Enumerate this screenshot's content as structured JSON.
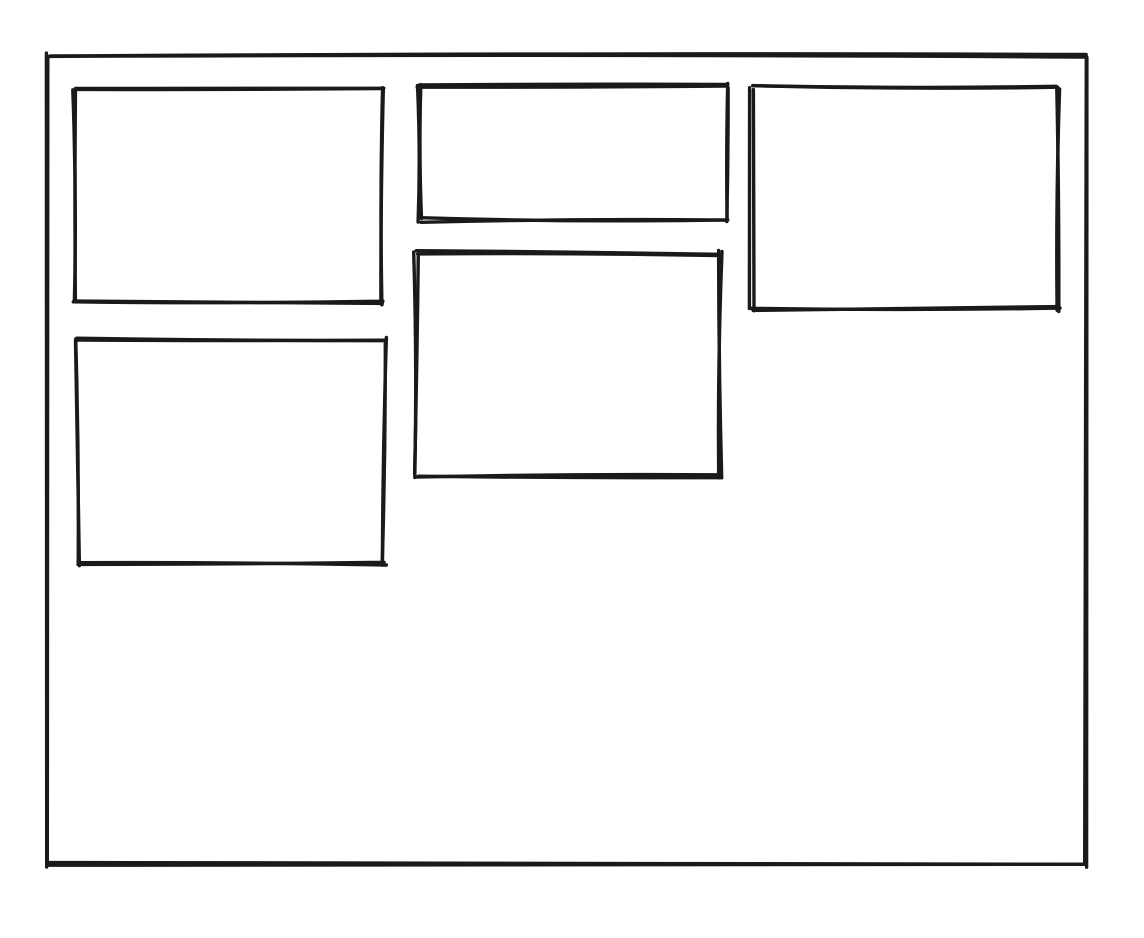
{
  "canvas": {
    "width": 1144,
    "height": 938,
    "background_color": "#ffffff"
  },
  "style": {
    "stroke_color": "#1a1a1a",
    "stroke_width": 3.4,
    "fill_color": "none",
    "sketch_jitter": 2.6
  },
  "frames": [
    {
      "name": "outer-frame",
      "x": 48,
      "y": 55,
      "w": 1038,
      "h": 810,
      "seed": 7
    },
    {
      "name": "panel-top-left",
      "x": 75,
      "y": 88,
      "w": 307,
      "h": 215,
      "seed": 11
    },
    {
      "name": "panel-top-center",
      "x": 419,
      "y": 86,
      "w": 307,
      "h": 134,
      "seed": 23
    },
    {
      "name": "panel-top-right",
      "x": 752,
      "y": 88,
      "w": 306,
      "h": 221,
      "seed": 31
    },
    {
      "name": "panel-middle-center",
      "x": 416,
      "y": 253,
      "w": 304,
      "h": 223,
      "seed": 43
    },
    {
      "name": "panel-middle-left",
      "x": 78,
      "y": 340,
      "w": 306,
      "h": 224,
      "seed": 59
    }
  ]
}
